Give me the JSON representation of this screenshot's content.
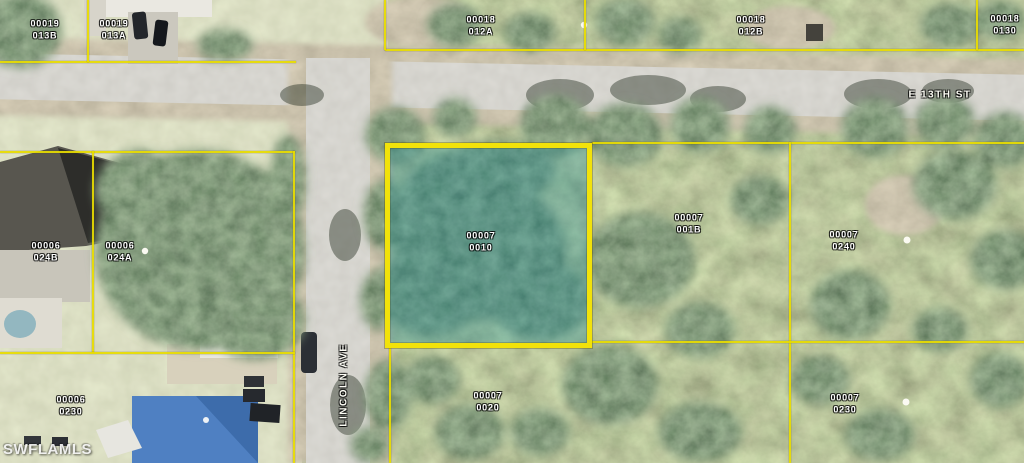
{
  "map": {
    "description": "Aerial parcel map with subject lot highlighted",
    "watermark": "SWFLAMLS",
    "streets": [
      {
        "name": "E 13TH ST",
        "orientation": "horizontal"
      },
      {
        "name": "LINCOLN AVE",
        "orientation": "vertical"
      }
    ],
    "parcels": [
      {
        "line1": "00019",
        "line2": "013B"
      },
      {
        "line1": "00019",
        "line2": "013A"
      },
      {
        "line1": "00018",
        "line2": "012A"
      },
      {
        "line1": "00018",
        "line2": "012B"
      },
      {
        "line1": "00018",
        "line2": "0130"
      },
      {
        "line1": "00006",
        "line2": "024B"
      },
      {
        "line1": "00006",
        "line2": "024A"
      },
      {
        "line1": "00007",
        "line2": "0010",
        "highlighted": true
      },
      {
        "line1": "00007",
        "line2": "001B"
      },
      {
        "line1": "00007",
        "line2": "0240"
      },
      {
        "line1": "00006",
        "line2": "0230"
      },
      {
        "line1": "00007",
        "line2": "0020"
      },
      {
        "line1": "00007",
        "line2": "0230"
      }
    ],
    "colors": {
      "parcel_line": "#e8dc00",
      "highlight_border": "#f2e20a",
      "highlight_fill": "rgba(24,134,150,0.34)",
      "road": "#b2afa4",
      "label_text": "#ffffff"
    }
  }
}
